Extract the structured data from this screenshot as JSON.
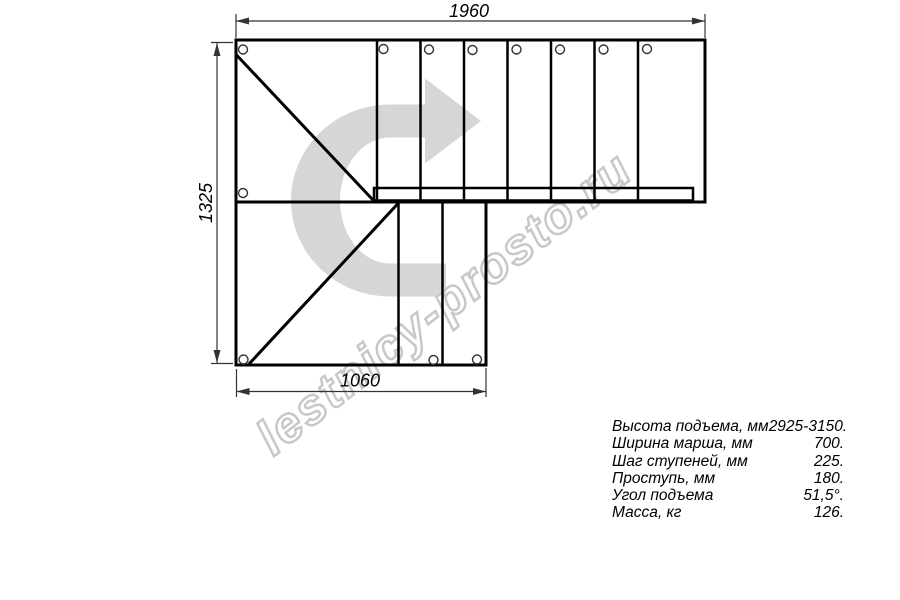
{
  "drawing": {
    "dim_width_top": "1960",
    "dim_height_left": "1325",
    "dim_width_bottom": "1060",
    "watermark": "lestnicy-prosto.ru"
  },
  "specs": {
    "rows": [
      {
        "label": "Высота подъема, мм",
        "value": "2925-3150."
      },
      {
        "label": "Ширина марша, мм",
        "value": "700."
      },
      {
        "label": "Шаг ступеней, мм",
        "value": "225."
      },
      {
        "label": "Проступь, мм",
        "value": "180."
      },
      {
        "label": "Угол подъема",
        "value": "51,5°."
      },
      {
        "label": "Масса, кг",
        "value": "126."
      }
    ]
  },
  "colors": {
    "background": "#ffffff",
    "line": "#000000",
    "dimension_line": "#333333",
    "direction_arrow": "#d6d6d6",
    "watermark_outline": "#c8c8c8"
  }
}
